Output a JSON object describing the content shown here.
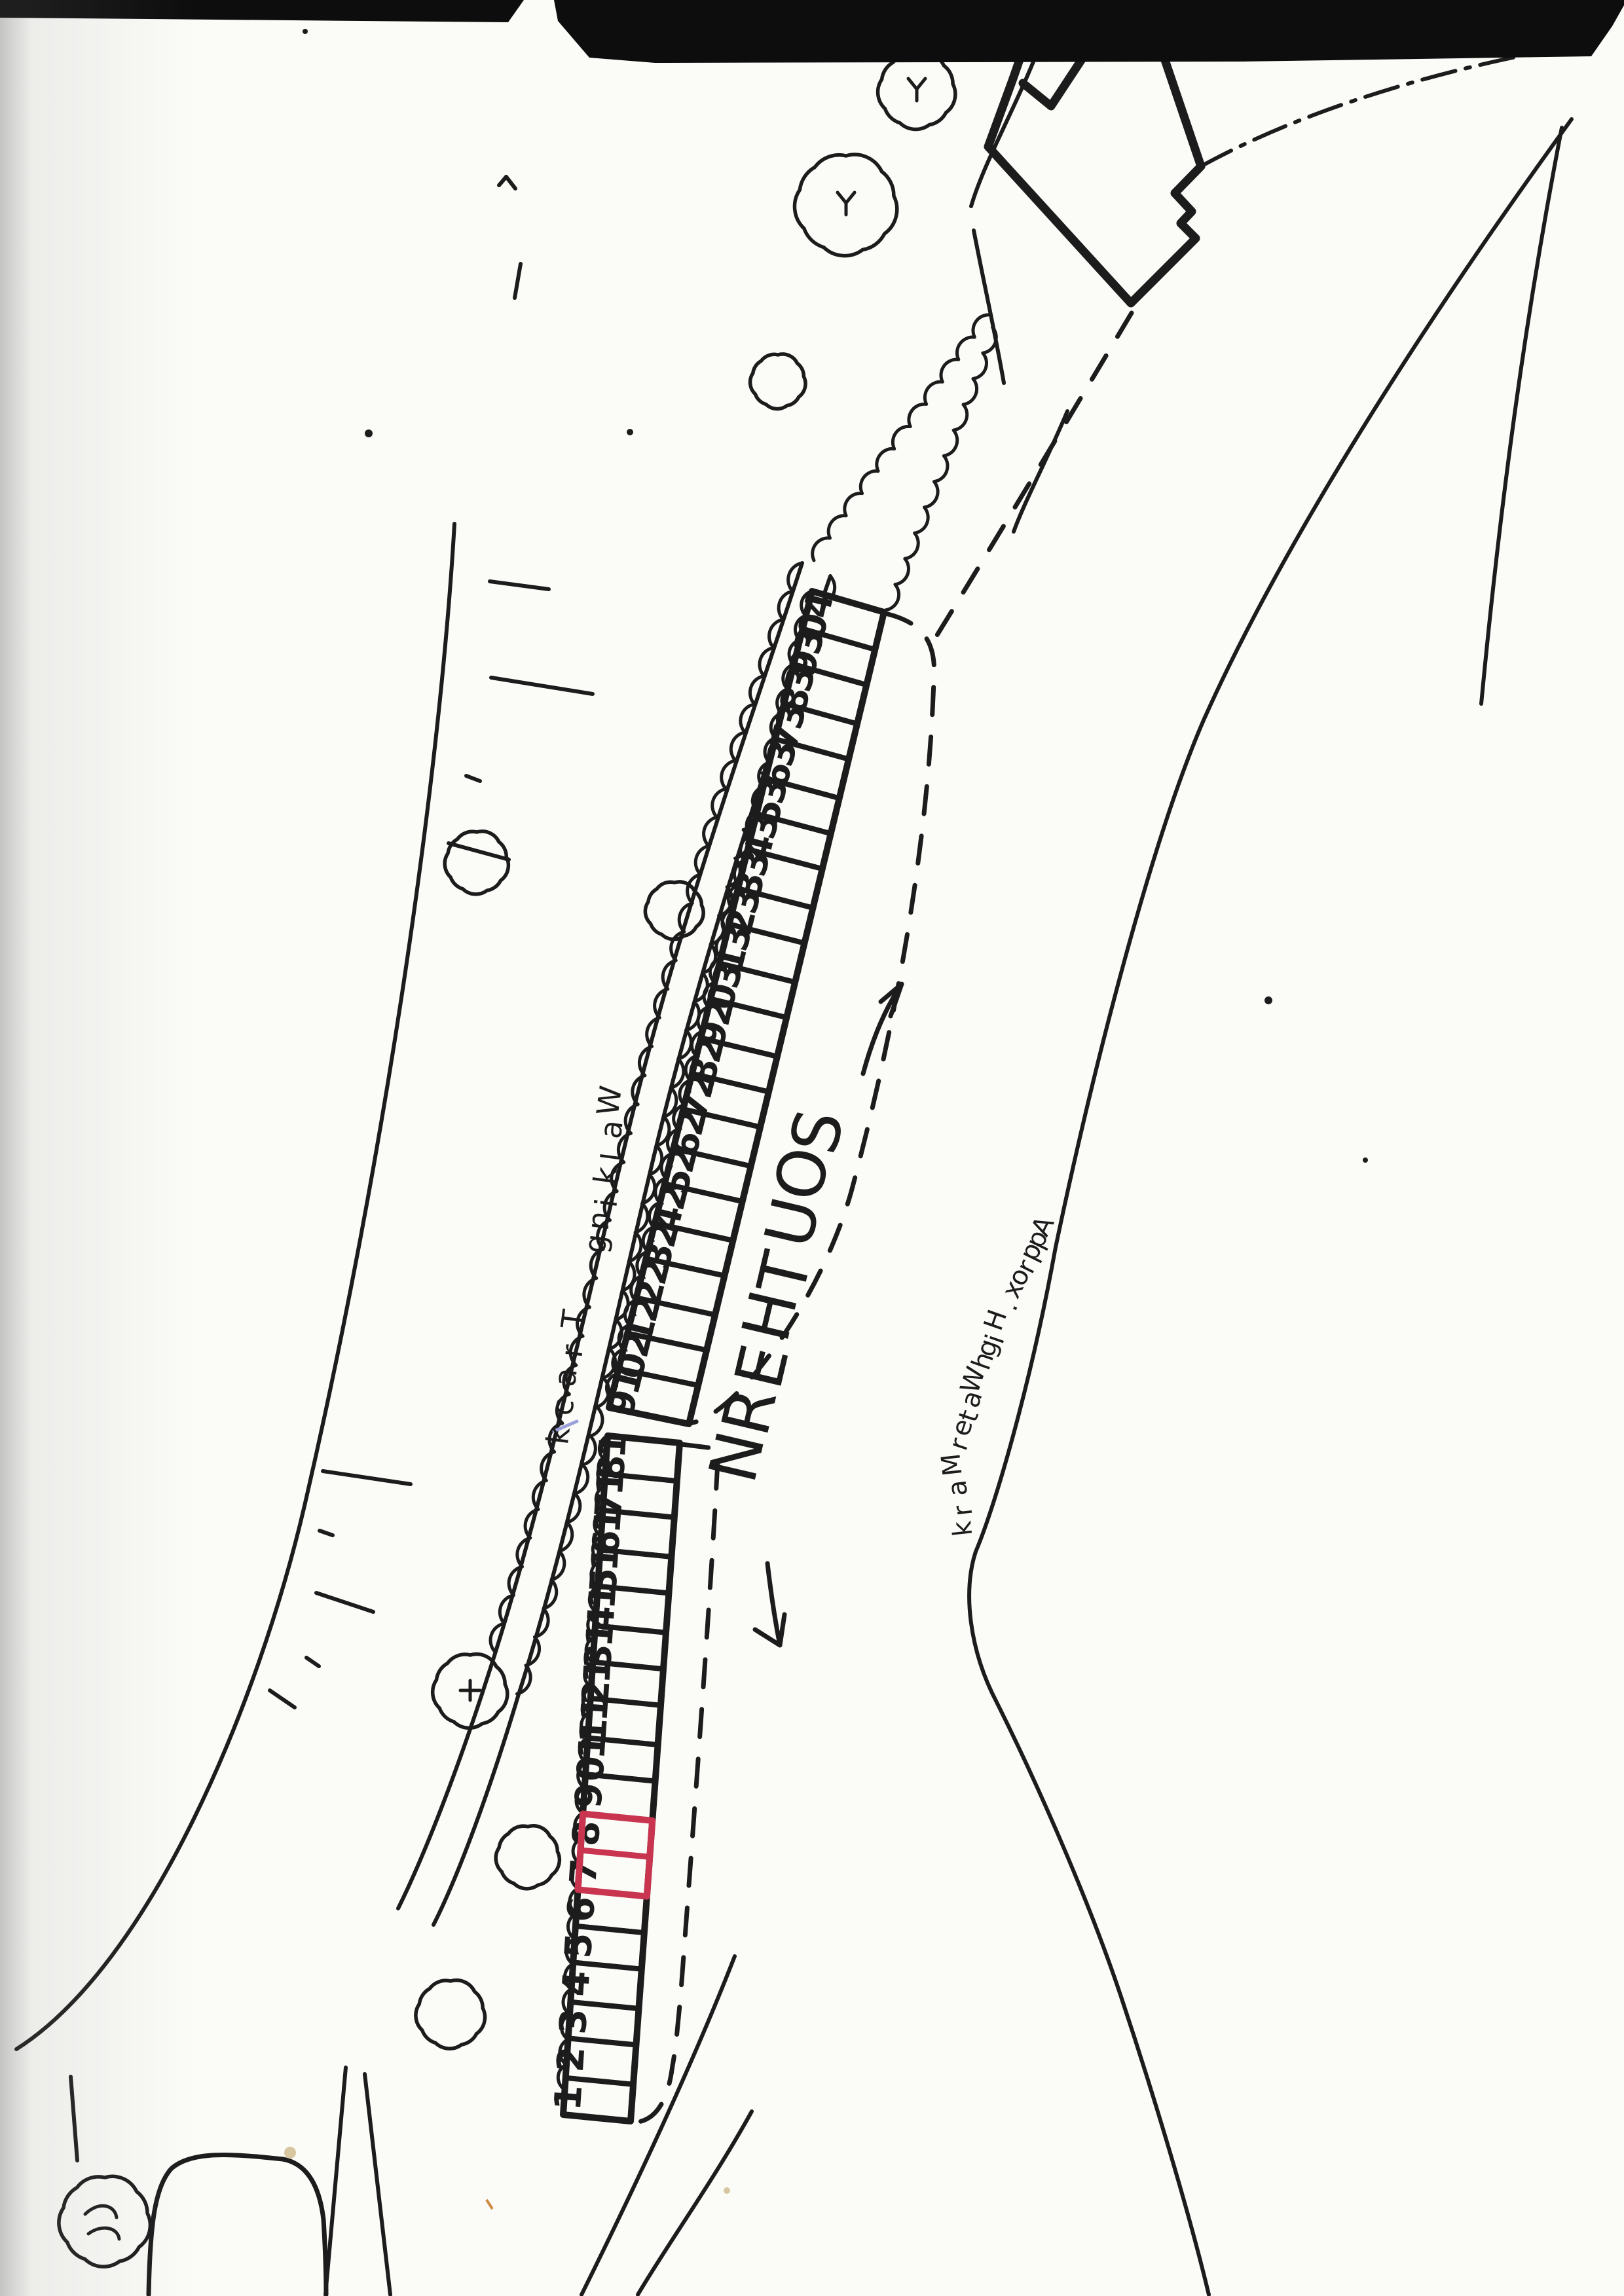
{
  "document": {
    "kind": "scanned hand-drawn plot allocation map",
    "background": "#fbfbf8",
    "ink_color": "#1c1c1c",
    "highlight_color": "#c9344f",
    "pen_mark_color": "#9aa0d8",
    "speck_color": "#d8c6a0"
  },
  "labels": {
    "region": "SOUTHERN",
    "track": "Walking Track",
    "water": "Approx. High Water Mark"
  },
  "plots": {
    "upper_strip": [
      40,
      39,
      38,
      37,
      36,
      35,
      34,
      33,
      32,
      31,
      30,
      29,
      28,
      27,
      26,
      25,
      24,
      23,
      22,
      21,
      20,
      19
    ],
    "lower_strip": [
      18,
      17,
      16,
      15,
      14,
      13,
      12,
      11,
      10,
      9,
      8,
      7,
      6,
      5,
      4,
      3,
      2,
      1
    ],
    "highlighted": [
      8,
      7
    ]
  },
  "icons": {
    "up_arrow": "direction-arrow-up",
    "down_arrow": "direction-arrow-down",
    "trees": "tree-icon",
    "building": "building-outline",
    "fence": "fence-dash-dot-line"
  }
}
